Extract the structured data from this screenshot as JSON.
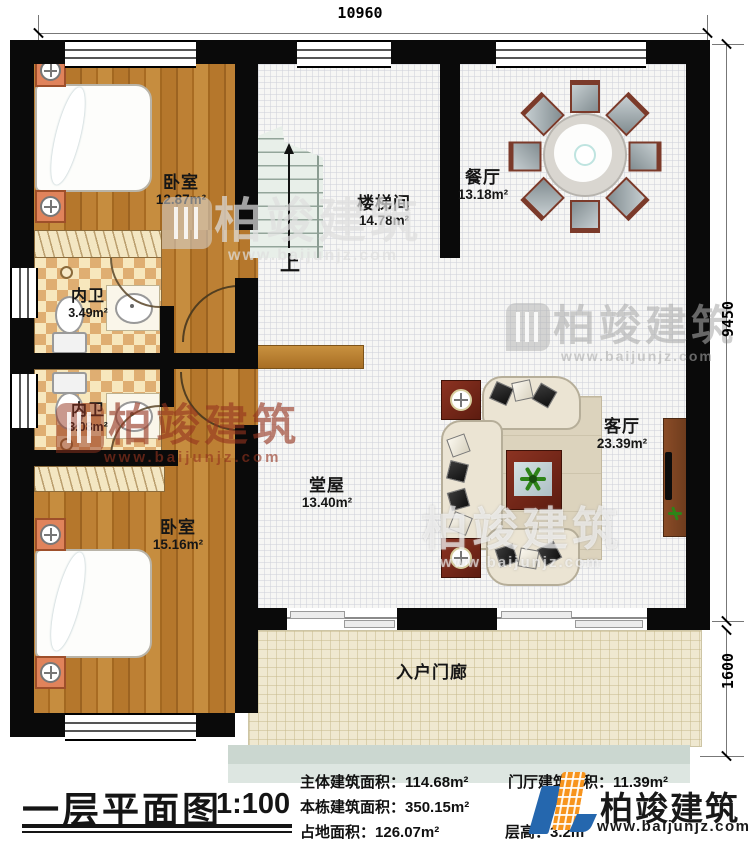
{
  "plan": {
    "dim_top": "10960",
    "dim_right_upper": "9450",
    "dim_right_lower": "1600",
    "stair_up": "上",
    "rooms": {
      "bedroom1": {
        "name": "卧室",
        "area": "12.87m²"
      },
      "stairwell": {
        "name": "楼梯间",
        "area": "14.78m²"
      },
      "dining": {
        "name": "餐厅",
        "area": "13.18m²"
      },
      "bath1": {
        "name": "内卫",
        "area": "3.49m²"
      },
      "bath2": {
        "name": "内卫",
        "area": "3.08m²"
      },
      "bedroom2": {
        "name": "卧室",
        "area": "15.16m²"
      },
      "hall": {
        "name": "堂屋",
        "area": "13.40m²"
      },
      "living": {
        "name": "客厅",
        "area": "23.39m²"
      },
      "porch": {
        "name": "入户门廊"
      }
    }
  },
  "footer": {
    "title": "一层平面图",
    "scale": "1:100",
    "stats": [
      {
        "label": "主体建筑面积：",
        "value": "114.68m²"
      },
      {
        "label": "门厅建筑面积：",
        "value": "11.39m²"
      },
      {
        "label": "本栋建筑面积：",
        "value": "350.15m²"
      },
      {
        "label": "占地面积：",
        "value": "126.07m²"
      },
      {
        "label": "层高：",
        "value": "3.2m"
      }
    ]
  },
  "brand": {
    "name": "柏竣建筑",
    "url": "www.baijunjz.com"
  },
  "colors": {
    "wall": "#0a0a0a",
    "wood": "#b5772c",
    "tile": "#dfae72",
    "hall_floor": "#f6f6f4",
    "porch_floor": "#efe8d0",
    "bed_blue": "#5fb4d8",
    "logo_orange": "#f7941d",
    "logo_blue": "#2567ae",
    "watermark_gray": "#c8c8c8",
    "watermark_red": "#8d3a26"
  }
}
